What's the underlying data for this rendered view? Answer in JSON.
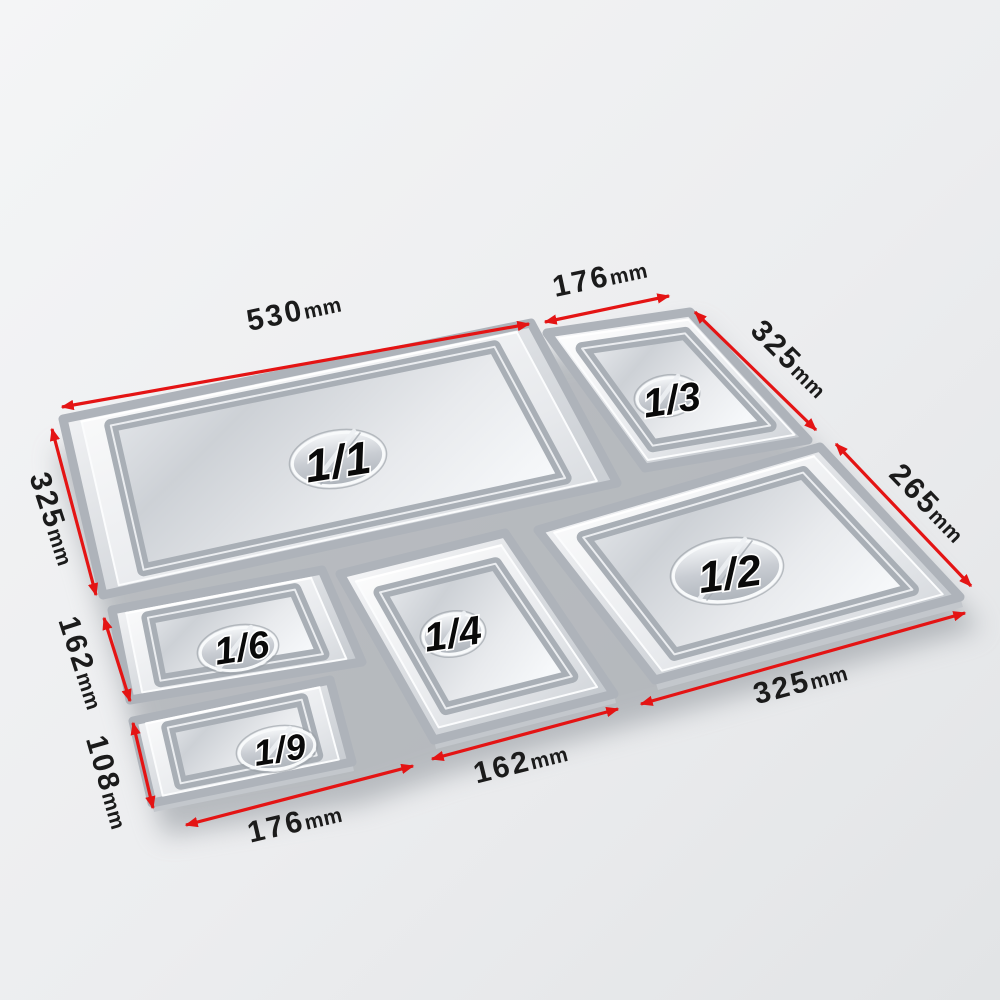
{
  "colors": {
    "arrow_red": "#e41414",
    "dimension_text": "#1b1b1b",
    "tray_label_text": "#0a0a0a",
    "tray_label_outline": "#ffffff",
    "metal_highlight": "#fdfdfe",
    "metal_mid": "#d9dce0",
    "metal_shadow": "#aeb3ba",
    "background_light": "#f4f5f6",
    "background_dark": "#e2e4e6"
  },
  "trays": [
    {
      "id": "gn-1-1",
      "label": "1/1"
    },
    {
      "id": "gn-1-3",
      "label": "1/3"
    },
    {
      "id": "gn-1-2",
      "label": "1/2"
    },
    {
      "id": "gn-1-6",
      "label": "1/6"
    },
    {
      "id": "gn-1-4",
      "label": "1/4"
    },
    {
      "id": "gn-1-9",
      "label": "1/9"
    }
  ],
  "dimensions": [
    {
      "position": "top-left",
      "value": "530",
      "unit": "mm"
    },
    {
      "position": "top-right",
      "value": "176",
      "unit": "mm"
    },
    {
      "position": "right-upper",
      "value": "325",
      "unit": "mm"
    },
    {
      "position": "right-lower",
      "value": "265",
      "unit": "mm"
    },
    {
      "position": "left-upper",
      "value": "325",
      "unit": "mm"
    },
    {
      "position": "left-middle",
      "value": "162",
      "unit": "mm"
    },
    {
      "position": "left-lower",
      "value": "108",
      "unit": "mm"
    },
    {
      "position": "bottom-left",
      "value": "176",
      "unit": "mm"
    },
    {
      "position": "bottom-middle",
      "value": "162",
      "unit": "mm"
    },
    {
      "position": "bottom-right",
      "value": "325",
      "unit": "mm"
    }
  ]
}
